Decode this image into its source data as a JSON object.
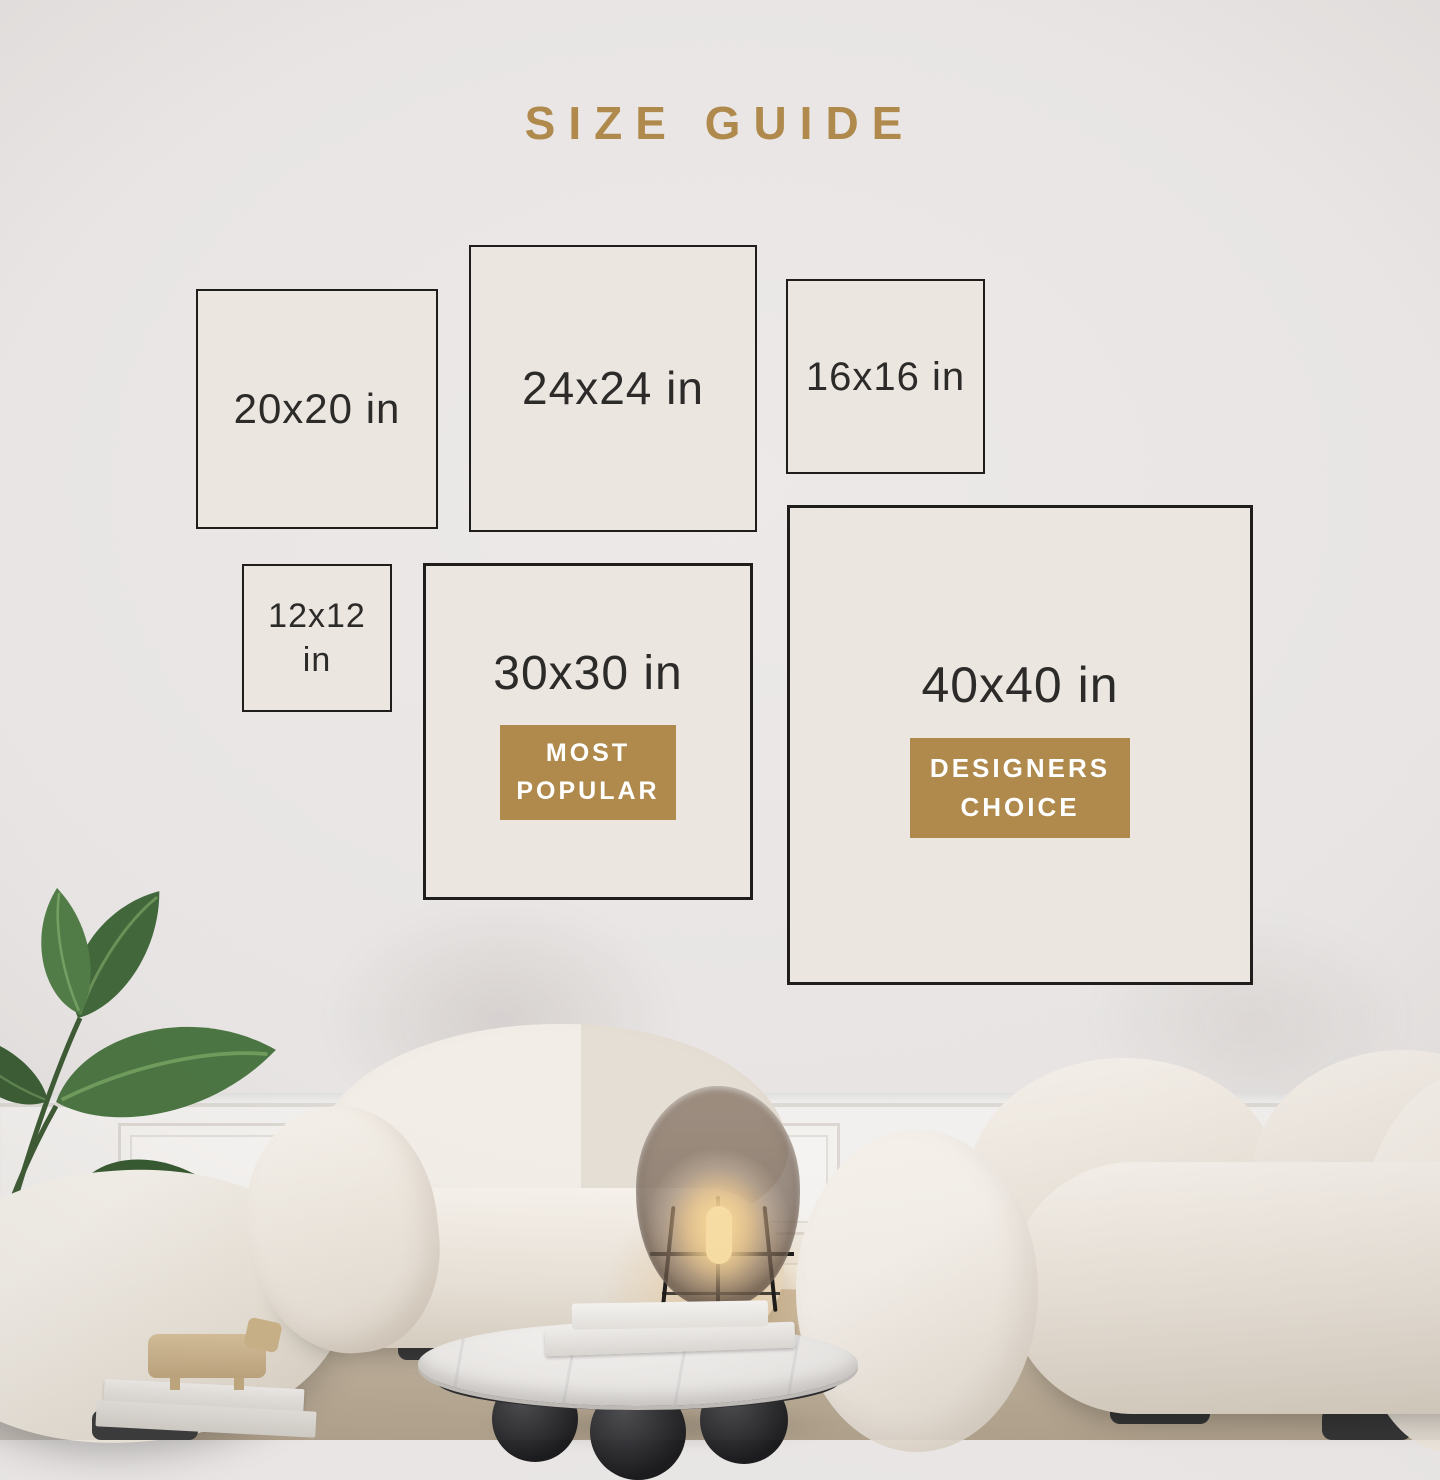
{
  "title": "SIZE GUIDE",
  "colors": {
    "accent": "#b08a4c",
    "box_border": "#1f1e1c",
    "box_fill": "#ebe6df",
    "label_text": "#2c2b29",
    "badge_text": "#ffffff"
  },
  "size_boxes": [
    {
      "label": "20x20 in"
    },
    {
      "label": "24x24 in"
    },
    {
      "label": "16x16 in"
    },
    {
      "label": "12x12 in"
    },
    {
      "label": "30x30 in",
      "badge": "MOST POPULAR"
    },
    {
      "label": "40x40 in",
      "badge": "DESIGNERS CHOICE"
    }
  ]
}
